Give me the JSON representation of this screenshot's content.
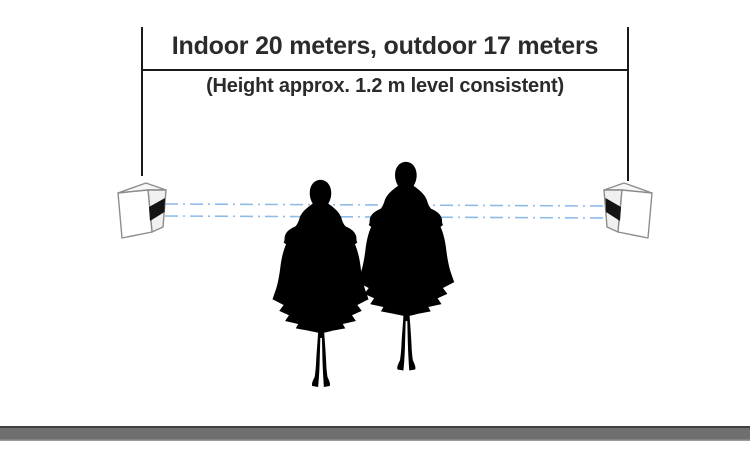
{
  "diagram": {
    "dimension": {
      "label": "Indoor 20 meters, outdoor 17 meters",
      "sublabel": "(Height approx. 1.2 m level consistent)"
    },
    "devices": [
      {
        "name": "left-beam-sensor"
      },
      {
        "name": "right-beam-sensor"
      }
    ],
    "beam": {
      "style": "dash-dot",
      "count": 2
    },
    "people": {
      "count": 2,
      "description": "two standing woman silhouettes between the sensors"
    }
  },
  "colors": {
    "text": "#2b2b2b",
    "dimension_line": "#1a1a1a",
    "beam_line": "#8fbce6",
    "device_outline": "#8c8c8c",
    "device_face": "#ffffff",
    "device_top": "#f7f7f7",
    "device_side": "#f0f0f0",
    "sensor_band": "#141414",
    "silhouette": "#000000",
    "floor": "#6f6f6f",
    "floor_edge_dark": "#3f3f3f",
    "floor_edge_light": "#9a9a9a",
    "background": "#ffffff"
  }
}
